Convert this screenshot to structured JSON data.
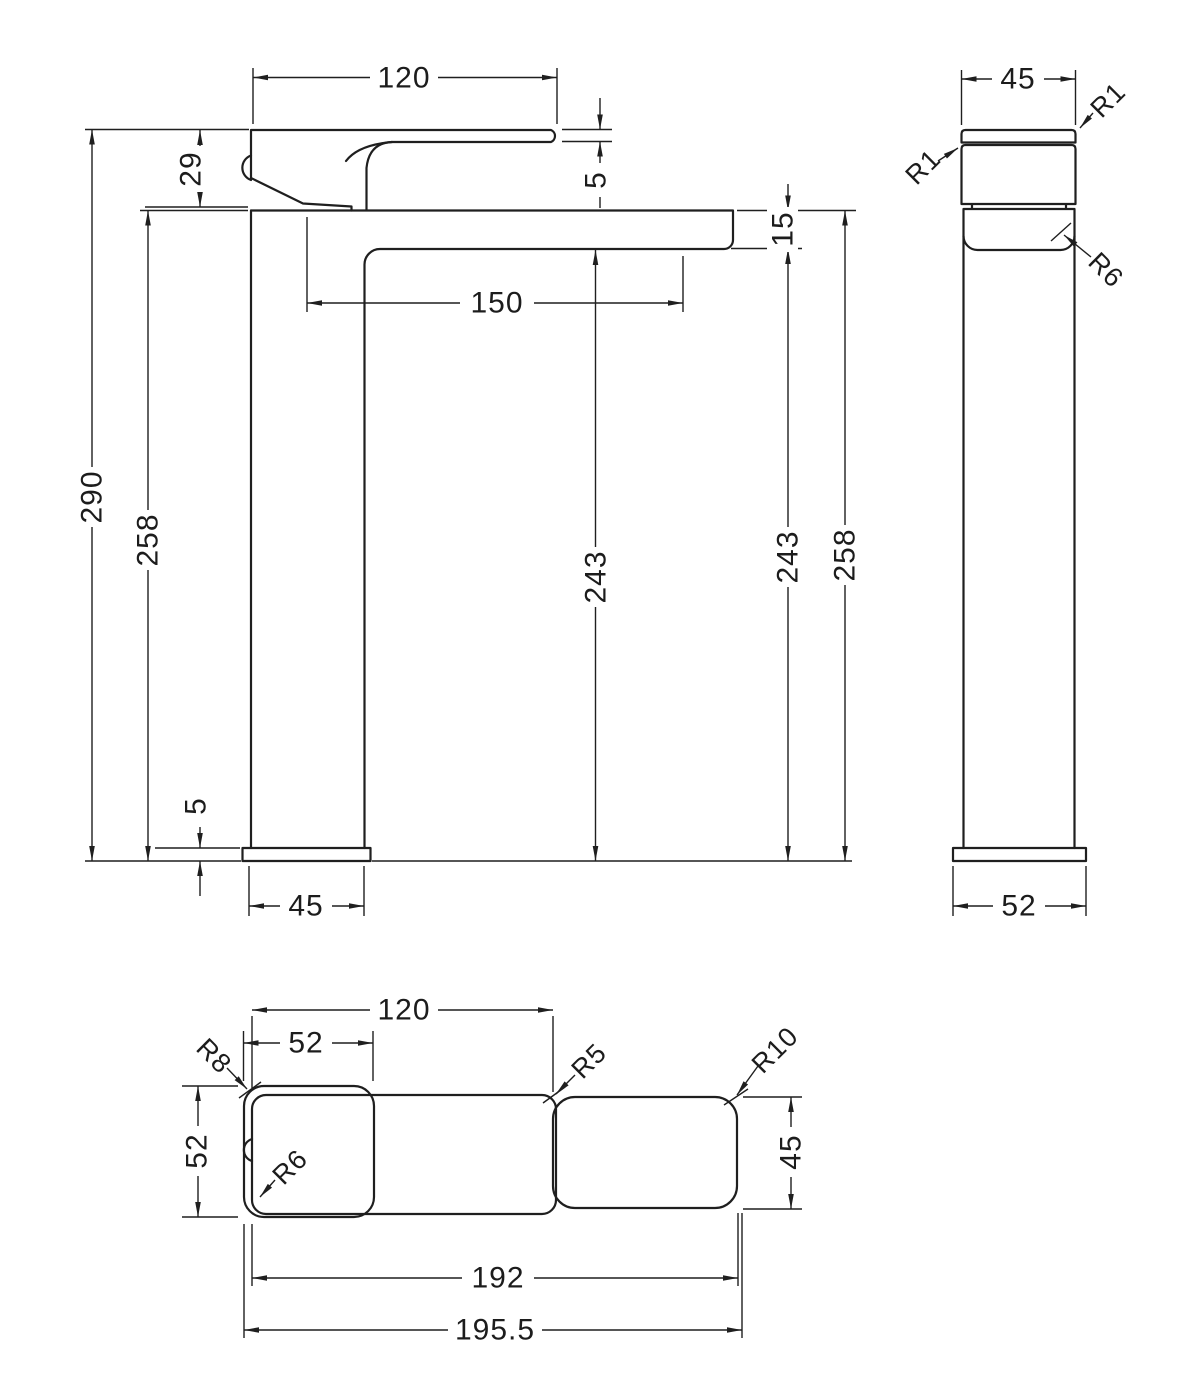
{
  "front_view": {
    "handle_length": "120",
    "handle_height": "29",
    "lever_thickness": "5",
    "spout_tip_height": "15",
    "spout_reach": "150",
    "overall_height": "290",
    "height_to_spout_left": "258",
    "clearance_mid": "243",
    "clearance_right": "243",
    "height_to_spout_right": "258",
    "base_plate_height": "5",
    "body_width": "45"
  },
  "side_view": {
    "handle_width": "45",
    "radius_handle_left": "R1",
    "radius_handle_right": "R1",
    "radius_spout_bottom": "R6",
    "base_width": "52"
  },
  "plan_view": {
    "handle_length": "120",
    "base_length": "52",
    "base_width": "52",
    "spout_width": "45",
    "radius_base_corner": "R8",
    "radius_handle_corner": "R6",
    "radius_spout_junction": "R5",
    "radius_spout_end": "R10",
    "length_to_spout_end": "192",
    "overall_length": "195.5"
  }
}
